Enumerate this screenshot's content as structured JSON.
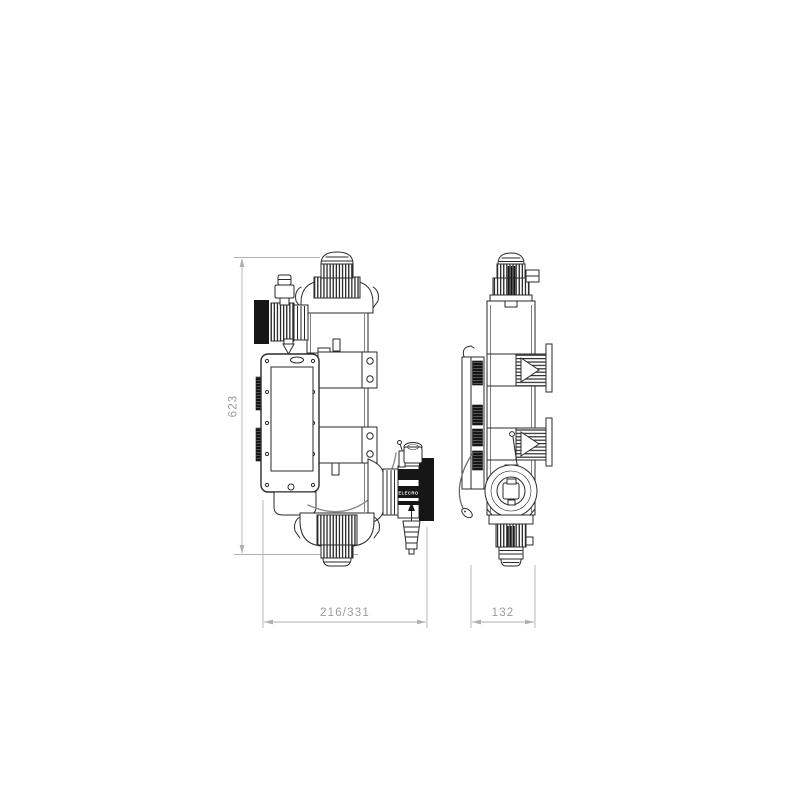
{
  "colors": {
    "background": "#ffffff",
    "artwork_line": "#2a2a2a",
    "solid_black_fill": "#161616",
    "dimension_line": "#b0b0b0",
    "dimension_text": "#9a9a9a",
    "cable": "#8d8d8d"
  },
  "dimensions": {
    "height_label": "623",
    "front_width_label": "216/331",
    "side_width_label": "132"
  },
  "labels": {
    "brand": "ELECRO"
  }
}
